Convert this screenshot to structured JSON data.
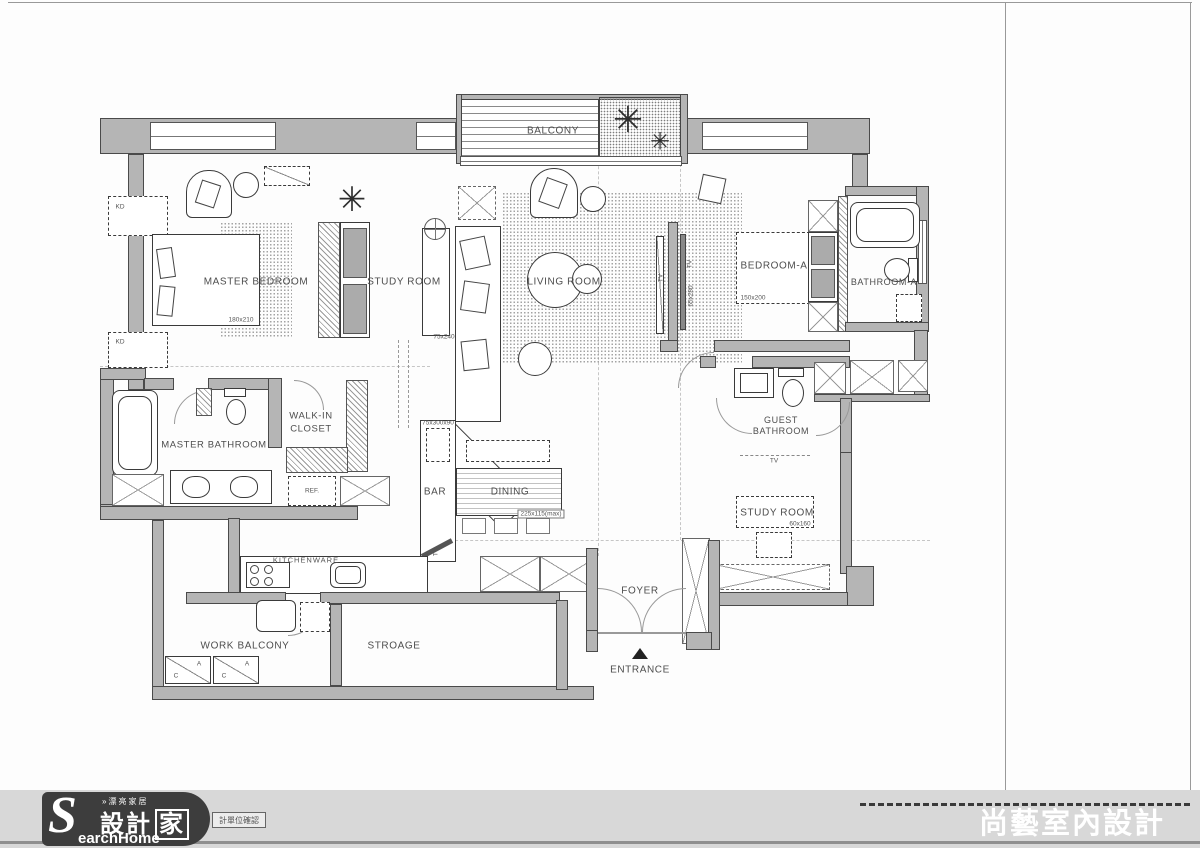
{
  "plan": {
    "labels": {
      "balcony": "BALCONY",
      "master_bedroom": "MASTER BEDROOM",
      "study_room": "STUDY ROOM",
      "living_room": "LIVING ROOM",
      "bedroom_a": "BEDROOM-A",
      "bathroom_a": "BATHROOM-A",
      "master_bathroom": "MASTER BATHROOM",
      "walk_in_1": "WALK-IN",
      "walk_in_2": "CLOSET",
      "guest_1": "GUEST",
      "guest_2": "BATHROOM",
      "study_room_2": "STUDY ROOM",
      "bar": "BAR",
      "dining": "DINING",
      "kitchenware": "KITCHENWARE",
      "work_balcony": "WORK BALCONY",
      "stroage": "STROAGE",
      "foyer": "FOYER",
      "entrance": "ENTRANCE",
      "ref": "REF.",
      "tv": "TV",
      "kd": "KD",
      "washer_a": "A",
      "washer_c": "C"
    },
    "dims": {
      "master_bed": "180x210",
      "study_desk": "75x240",
      "bedroom_a_bed": "150x200",
      "tv_wall": "65x280",
      "bar_counter": "75x300x90",
      "dining_table": "225x115(max)",
      "study2_desk": "60x160"
    }
  },
  "title_block": {
    "brand": "SHANG YIH",
    "company_zh": "尚藝室內設計有限公司",
    "company_en": "INTERIOR DESIGN CO.LTD",
    "address_zh": "台北市中山北路二段39巷10號3樓",
    "address_en": "3F., No.10, Lane 39, Sec. 2, Zhongshan N. Rd.,TAIPEI,TAIWAN",
    "tel_fax": "TEL: (02)25677757   FAX: (02)25677828",
    "email": "E-MAIL: shang885@hotmail.com",
    "revision": {
      "heading": "DATE REVISION",
      "rows": [
        {
          "k": "A:",
          "v": "設計室內坪數 : 38.5坪"
        },
        {
          "k": "B:",
          "v": "(不含客浴,浴室A,前陽台,工作陽台,儲藏室)"
        },
        {
          "k": "C:",
          "v": "前陽台坪數　: 1.5坪"
        },
        {
          "k": "D:",
          "v": ""
        },
        {
          "k": "E:",
          "v": ""
        },
        {
          "k": "F:",
          "v": ""
        },
        {
          "k": "G:",
          "v": ""
        },
        {
          "k": "H:",
          "v": ""
        }
      ]
    },
    "credits": [
      {
        "label": "DRAWING BY",
        "value": "王偉丞"
      },
      {
        "label": "DESIGNED BY",
        "value": "王偉丞"
      },
      {
        "label": "CONCEPT BY",
        "value": "王偉丞"
      }
    ],
    "project": {
      "zh": "工程名稱",
      "en": "PROJECT NAME",
      "value": "奧斯卡A3-5F康公館"
    },
    "scale": {
      "zh": "比例",
      "en": "SCALE",
      "value": "1:60"
    },
    "date": {
      "zh": "日期",
      "en": "DATE",
      "value": "2014/04/30"
    },
    "drawing_title": {
      "zh": "圖名",
      "en": "DRAWING TITLE",
      "value": "平面配置圖"
    },
    "drawing_no": {
      "zh": "圖號",
      "en": "DRAWING NO.",
      "value": "PN-02"
    },
    "sheet": {
      "label": "SHEET NO.",
      "value": "03"
    }
  },
  "footer": {
    "logo": {
      "tagline": "»漂亮家居",
      "zh_1": "設計",
      "zh_2": "家",
      "s": "S",
      "en": "earchHome"
    },
    "stamp": "計單位確認",
    "watermark": "尚藝室內設計"
  }
}
